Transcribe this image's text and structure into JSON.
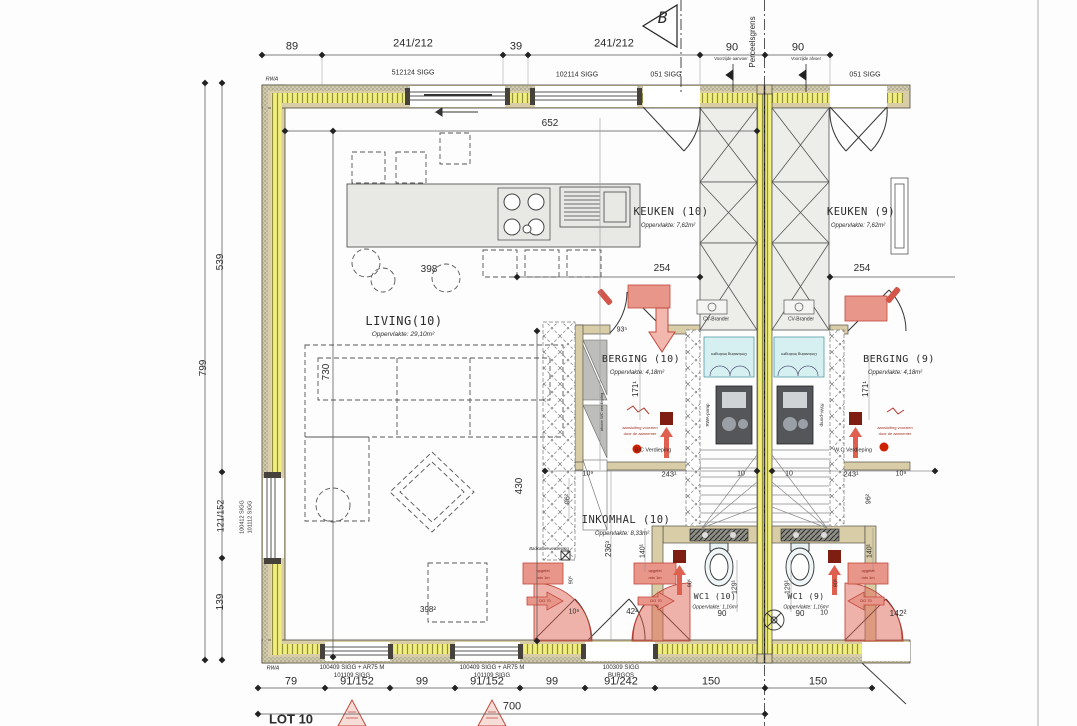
{
  "drawing": {
    "type": "architectural-floorplan",
    "lot": "LOT 10",
    "section_marker": "B",
    "boundary_label": "Perceelsgrens"
  },
  "colors": {
    "insulation_yellow": "#f1ee7d",
    "wall_tan": "#d8cda6",
    "annotation_red": "#c2473a",
    "stair_teal": "#d6f0f2",
    "line_dark": "#3c3c3c"
  },
  "labels": [
    {
      "n": "dim-top-89",
      "t": "89",
      "x": 292,
      "y": 47,
      "s": 11
    },
    {
      "n": "dim-top-241a",
      "t": "241/212",
      "x": 413,
      "y": 44,
      "s": 11
    },
    {
      "n": "dim-top-39",
      "t": "39",
      "x": 516,
      "y": 47,
      "s": 11
    },
    {
      "n": "dim-top-241b",
      "t": "241/212",
      "x": 614,
      "y": 44,
      "s": 11
    },
    {
      "n": "dim-top-90a",
      "t": "90",
      "x": 732,
      "y": 48,
      "s": 11
    },
    {
      "n": "dim-top-90b",
      "t": "90",
      "x": 798,
      "y": 48,
      "s": 11
    },
    {
      "n": "window-label-512124",
      "t": "512124 SIGG",
      "x": 413,
      "y": 73,
      "s": 7
    },
    {
      "n": "window-label-102114",
      "t": "102114 SIGG",
      "x": 577,
      "y": 75,
      "s": 7
    },
    {
      "n": "window-label-051a",
      "t": "051 SIGG",
      "x": 666,
      "y": 75,
      "s": 7
    },
    {
      "n": "window-label-051b",
      "t": "051 SIGG",
      "x": 865,
      "y": 75,
      "s": 7
    },
    {
      "n": "section-marker-b",
      "t": "B",
      "x": 663,
      "y": 18,
      "s": 16,
      "i": 1,
      "f": "m"
    },
    {
      "n": "perceelsgrens-label",
      "t": "Perceelsgrens",
      "x": 753,
      "y": 42,
      "r": -90,
      "s": 8
    },
    {
      "n": "flag-voorzijde-aanvoer",
      "t": "Voorzijde aanvoer",
      "x": 731,
      "y": 59,
      "s": 4.2
    },
    {
      "n": "flag-voorzijde-afvoer",
      "t": "Voorzijde afvoer",
      "x": 806,
      "y": 59,
      "s": 4.2
    },
    {
      "n": "rwa-top-label",
      "t": "RWA",
      "x": 272,
      "y": 80,
      "s": 5.5,
      "i": 1
    },
    {
      "n": "rwa-bottom-label",
      "t": "RWA",
      "x": 273,
      "y": 669,
      "s": 5.5,
      "i": 1
    },
    {
      "n": "dim-652",
      "t": "652",
      "x": 550,
      "y": 124,
      "s": 10
    },
    {
      "n": "room-keuken10",
      "t": "KEUKEN (10)",
      "x": 671,
      "y": 212,
      "s": 10.5,
      "f": "m"
    },
    {
      "n": "area-keuken10",
      "t": "Oppervlakte: 7,62m²",
      "x": 668,
      "y": 226,
      "s": 6,
      "i": 1
    },
    {
      "n": "room-keuken9",
      "t": "KEUKEN (9)",
      "x": 861,
      "y": 212,
      "s": 10.5,
      "f": "m"
    },
    {
      "n": "area-keuken9",
      "t": "Oppervlakte: 7,62m²",
      "x": 858,
      "y": 226,
      "s": 6,
      "i": 1
    },
    {
      "n": "dim-398-top",
      "t": "398",
      "x": 429,
      "y": 270,
      "s": 10
    },
    {
      "n": "dim-254-left",
      "t": "254",
      "x": 662,
      "y": 269,
      "s": 10
    },
    {
      "n": "dim-254-right",
      "t": "254",
      "x": 862,
      "y": 269,
      "s": 10
    },
    {
      "n": "cv-brander-left",
      "t": "CV-Brander",
      "x": 716,
      "y": 320,
      "s": 5
    },
    {
      "n": "cv-brander-right",
      "t": "CV-Brander",
      "x": 801,
      "y": 320,
      "s": 5
    },
    {
      "n": "room-living",
      "t": "LIVING(10)",
      "x": 404,
      "y": 321,
      "s": 12,
      "f": "m"
    },
    {
      "n": "area-living",
      "t": "Oppervlakte: 29,10m²",
      "x": 403,
      "y": 335,
      "s": 6.5,
      "i": 1
    },
    {
      "n": "dim-730",
      "t": "730",
      "x": 327,
      "y": 372,
      "r": -90,
      "s": 10
    },
    {
      "n": "dim-93-5",
      "t": "93⁵",
      "x": 622,
      "y": 330,
      "s": 7
    },
    {
      "n": "room-berging10",
      "t": "BERGING (10)",
      "x": 641,
      "y": 360,
      "s": 10,
      "f": "m"
    },
    {
      "n": "area-berging10",
      "t": "Oppervlakte: 4,18m²",
      "x": 637,
      "y": 373,
      "s": 6,
      "i": 1
    },
    {
      "n": "room-berging9",
      "t": "BERGING (9)",
      "x": 899,
      "y": 360,
      "s": 10,
      "f": "m"
    },
    {
      "n": "area-berging9",
      "t": "Oppervlakte: 4,18m²",
      "x": 895,
      "y": 373,
      "s": 6,
      "i": 1
    },
    {
      "n": "dim-171-left",
      "t": "171¹",
      "x": 636,
      "y": 389,
      "r": -90,
      "s": 8
    },
    {
      "n": "dim-171-right",
      "t": "171¹",
      "x": 866,
      "y": 389,
      "r": -90,
      "s": 8
    },
    {
      "n": "stair-landing-note-left",
      "t": "Omkasting leidingen",
      "x": 729,
      "y": 354,
      "r": 180,
      "s": 4
    },
    {
      "n": "stair-landing-note-right",
      "t": "Omkasting leidingen",
      "x": 799,
      "y": 354,
      "r": 180,
      "s": 4
    },
    {
      "n": "rwa-pomp-left",
      "t": "RWA-pomp",
      "x": 708,
      "y": 415,
      "r": -90,
      "s": 4.5
    },
    {
      "n": "rwa-pomp-right",
      "t": "RWA-pomp",
      "x": 821,
      "y": 415,
      "r": 90,
      "s": 4.5
    },
    {
      "n": "note-berging-left-1",
      "t": "aansluiting voorzien",
      "x": 640,
      "y": 428,
      "s": 4,
      "c": "#a03022"
    },
    {
      "n": "note-berging-left-2",
      "t": "door de aannemer",
      "x": 640,
      "y": 434,
      "s": 4,
      "c": "#a03022"
    },
    {
      "n": "note-berging-right-1",
      "t": "aansluiting voorzien",
      "x": 895,
      "y": 428,
      "s": 4,
      "c": "#a03022"
    },
    {
      "n": "note-berging-right-2",
      "t": "door de aannemer",
      "x": 895,
      "y": 434,
      "s": 4,
      "c": "#a03022"
    },
    {
      "n": "bc-verdieping-note",
      "t": "B/C Verdieping",
      "x": 653,
      "y": 451,
      "s": 5.5
    },
    {
      "n": "wc-verdieping-note",
      "t": "W.C Verdieping",
      "x": 853,
      "y": 451,
      "s": 5.5
    },
    {
      "n": "afvoer-vert-note",
      "t": "afvoer WC verdieping",
      "x": 602,
      "y": 412,
      "r": -90,
      "s": 4
    },
    {
      "n": "dim-539",
      "t": "539",
      "x": 221,
      "y": 262,
      "r": -90,
      "s": 10
    },
    {
      "n": "dim-799",
      "t": "799",
      "x": 204,
      "y": 368,
      "r": -90,
      "s": 10
    },
    {
      "n": "dim-121-152",
      "t": "121/152",
      "x": 221,
      "y": 516,
      "r": -90,
      "s": 9
    },
    {
      "n": "dim-139",
      "t": "139",
      "x": 221,
      "y": 602,
      "r": -90,
      "s": 10
    },
    {
      "n": "window-label-100412",
      "t": "100412 SIGG",
      "x": 243,
      "y": 517,
      "r": -90,
      "s": 5.5
    },
    {
      "n": "window-label-101112",
      "t": "101112 SIGG",
      "x": 251,
      "y": 517,
      "r": -90,
      "s": 5.5
    },
    {
      "n": "dim-430",
      "t": "430",
      "x": 520,
      "y": 486,
      "r": -90,
      "s": 10
    },
    {
      "n": "note-badkamer",
      "t": "Badkamer verdieping",
      "x": 549,
      "y": 549,
      "s": 4.2,
      "i": 1
    },
    {
      "n": "room-inkomhal",
      "t": "INKOMHAL (10)",
      "x": 626,
      "y": 520,
      "s": 10.5,
      "f": "m"
    },
    {
      "n": "area-inkomhal",
      "t": "Oppervlakte: 8,33m²",
      "x": 622,
      "y": 534,
      "s": 6,
      "i": 1
    },
    {
      "n": "dim-109-a",
      "t": "10⁹",
      "x": 588,
      "y": 474,
      "s": 7
    },
    {
      "n": "dim-243-left",
      "t": "243¹",
      "x": 669,
      "y": 474,
      "s": 7.5
    },
    {
      "n": "dim-10-left",
      "t": "10",
      "x": 741,
      "y": 474,
      "s": 7
    },
    {
      "n": "dim-10-right",
      "t": "10",
      "x": 789,
      "y": 474,
      "s": 7
    },
    {
      "n": "dim-243-right",
      "t": "243¹",
      "x": 851,
      "y": 474,
      "s": 7.5
    },
    {
      "n": "dim-109-right",
      "t": "10⁹",
      "x": 901,
      "y": 474,
      "s": 7
    },
    {
      "n": "dim-96-left",
      "t": "96²",
      "x": 568,
      "y": 499,
      "r": -90,
      "s": 7
    },
    {
      "n": "dim-96-right",
      "t": "96²",
      "x": 869,
      "y": 499,
      "r": -90,
      "s": 7
    },
    {
      "n": "dim-236",
      "t": "236³",
      "x": 609,
      "y": 549,
      "r": -90,
      "s": 8
    },
    {
      "n": "dim-140-left",
      "t": "140¹",
      "x": 643,
      "y": 551,
      "r": -90,
      "s": 7
    },
    {
      "n": "dim-140-right",
      "t": "140¹",
      "x": 870,
      "y": 551,
      "r": -90,
      "s": 7
    },
    {
      "n": "dim-905-a",
      "t": "90⁵",
      "x": 572,
      "y": 580,
      "r": -90,
      "s": 5.5
    },
    {
      "n": "dim-905-b",
      "t": "90⁵",
      "x": 691,
      "y": 583,
      "r": -90,
      "s": 5.5
    },
    {
      "n": "dim-905-c",
      "t": "90⁵",
      "x": 837,
      "y": 583,
      "r": -90,
      "s": 5.5
    },
    {
      "n": "room-wc10",
      "t": "WC1 (10)",
      "x": 715,
      "y": 597,
      "s": 8,
      "f": "m"
    },
    {
      "n": "area-wc10",
      "t": "Oppervlakte: 1,16m²",
      "x": 715,
      "y": 608,
      "s": 5,
      "i": 1
    },
    {
      "n": "room-wc9",
      "t": "WC1 (9)",
      "x": 806,
      "y": 597,
      "s": 8,
      "f": "m"
    },
    {
      "n": "area-wc9",
      "t": "Oppervlakte: 1,16m²",
      "x": 806,
      "y": 608,
      "s": 5,
      "i": 1
    },
    {
      "n": "dim-129-left",
      "t": "129¹",
      "x": 735,
      "y": 587,
      "r": -90,
      "s": 7
    },
    {
      "n": "dim-129-right",
      "t": "129¹",
      "x": 788,
      "y": 587,
      "r": -90,
      "s": 7
    },
    {
      "n": "dim-90-left",
      "t": "90",
      "x": 722,
      "y": 614,
      "s": 8
    },
    {
      "n": "dim-90-right",
      "t": "90",
      "x": 800,
      "y": 614,
      "s": 8
    },
    {
      "n": "dim-10-wc",
      "t": "10",
      "x": 824,
      "y": 613,
      "s": 7
    },
    {
      "n": "dim-109-b",
      "t": "10⁹",
      "x": 574,
      "y": 612,
      "s": 7
    },
    {
      "n": "dim-42",
      "t": "42²",
      "x": 632,
      "y": 612,
      "s": 8
    },
    {
      "n": "dim-398-bottom",
      "t": "398²",
      "x": 428,
      "y": 610,
      "s": 8
    },
    {
      "n": "dim-142",
      "t": "142²",
      "x": 898,
      "y": 613,
      "s": 8.5
    },
    {
      "n": "door-note-a1",
      "t": "opgelet",
      "x": 543,
      "y": 571,
      "s": 4,
      "c": "#8a2318"
    },
    {
      "n": "door-note-a2",
      "t": "min 1m",
      "x": 543,
      "y": 578,
      "s": 4,
      "c": "#8a2318"
    },
    {
      "n": "door-note-b1",
      "t": "opgelet",
      "x": 655,
      "y": 571,
      "s": 4,
      "c": "#8a2318"
    },
    {
      "n": "door-note-b2",
      "t": "min 1m",
      "x": 655,
      "y": 578,
      "s": 4,
      "c": "#8a2318"
    },
    {
      "n": "door-note-c1",
      "t": "opgelet",
      "x": 868,
      "y": 571,
      "s": 4,
      "c": "#8a2318"
    },
    {
      "n": "door-note-c2",
      "t": "min 1m",
      "x": 868,
      "y": 578,
      "s": 4,
      "c": "#8a2318"
    },
    {
      "n": "door-arrow-a",
      "t": "DO 70",
      "x": 545,
      "y": 601,
      "s": 4,
      "c": "#8a2318"
    },
    {
      "n": "door-arrow-b",
      "t": "DO 70",
      "x": 656,
      "y": 601,
      "s": 4,
      "c": "#8a2318"
    },
    {
      "n": "door-arrow-c",
      "t": "DO 70",
      "x": 866,
      "y": 601,
      "s": 4,
      "c": "#8a2318"
    },
    {
      "n": "bottom-window-a1",
      "t": "100409 SIGG + AR75 M",
      "x": 352,
      "y": 668,
      "s": 6
    },
    {
      "n": "bottom-window-a2",
      "t": "101109 SIGG",
      "x": 352,
      "y": 676,
      "s": 6
    },
    {
      "n": "bottom-window-b1",
      "t": "100409 SIGG + AR75 M",
      "x": 492,
      "y": 668,
      "s": 6
    },
    {
      "n": "bottom-window-b2",
      "t": "101109 SIGG",
      "x": 492,
      "y": 676,
      "s": 6
    },
    {
      "n": "bottom-door-c1",
      "t": "100309 SIGG",
      "x": 621,
      "y": 668,
      "s": 6
    },
    {
      "n": "bottom-door-c2",
      "t": "BURGOS",
      "x": 621,
      "y": 676,
      "s": 6
    },
    {
      "n": "dim-bot-79",
      "t": "79",
      "x": 291,
      "y": 682,
      "s": 11
    },
    {
      "n": "dim-bot-91a",
      "t": "91/152",
      "x": 357,
      "y": 682,
      "s": 11
    },
    {
      "n": "dim-bot-99a",
      "t": "99",
      "x": 422,
      "y": 682,
      "s": 11
    },
    {
      "n": "dim-bot-91b",
      "t": "91/152",
      "x": 487,
      "y": 682,
      "s": 11
    },
    {
      "n": "dim-bot-99b",
      "t": "99",
      "x": 552,
      "y": 682,
      "s": 11
    },
    {
      "n": "dim-bot-91242",
      "t": "91/242",
      "x": 621,
      "y": 682,
      "s": 11
    },
    {
      "n": "dim-bot-150a",
      "t": "150",
      "x": 711,
      "y": 682,
      "s": 11
    },
    {
      "n": "dim-bot-150b",
      "t": "150",
      "x": 818,
      "y": 682,
      "s": 11
    },
    {
      "n": "dim-700",
      "t": "700",
      "x": 512,
      "y": 707,
      "s": 11
    },
    {
      "n": "lot-10-label",
      "t": "LOT 10",
      "x": 291,
      "y": 719,
      "s": 13,
      "w": 1
    }
  ]
}
